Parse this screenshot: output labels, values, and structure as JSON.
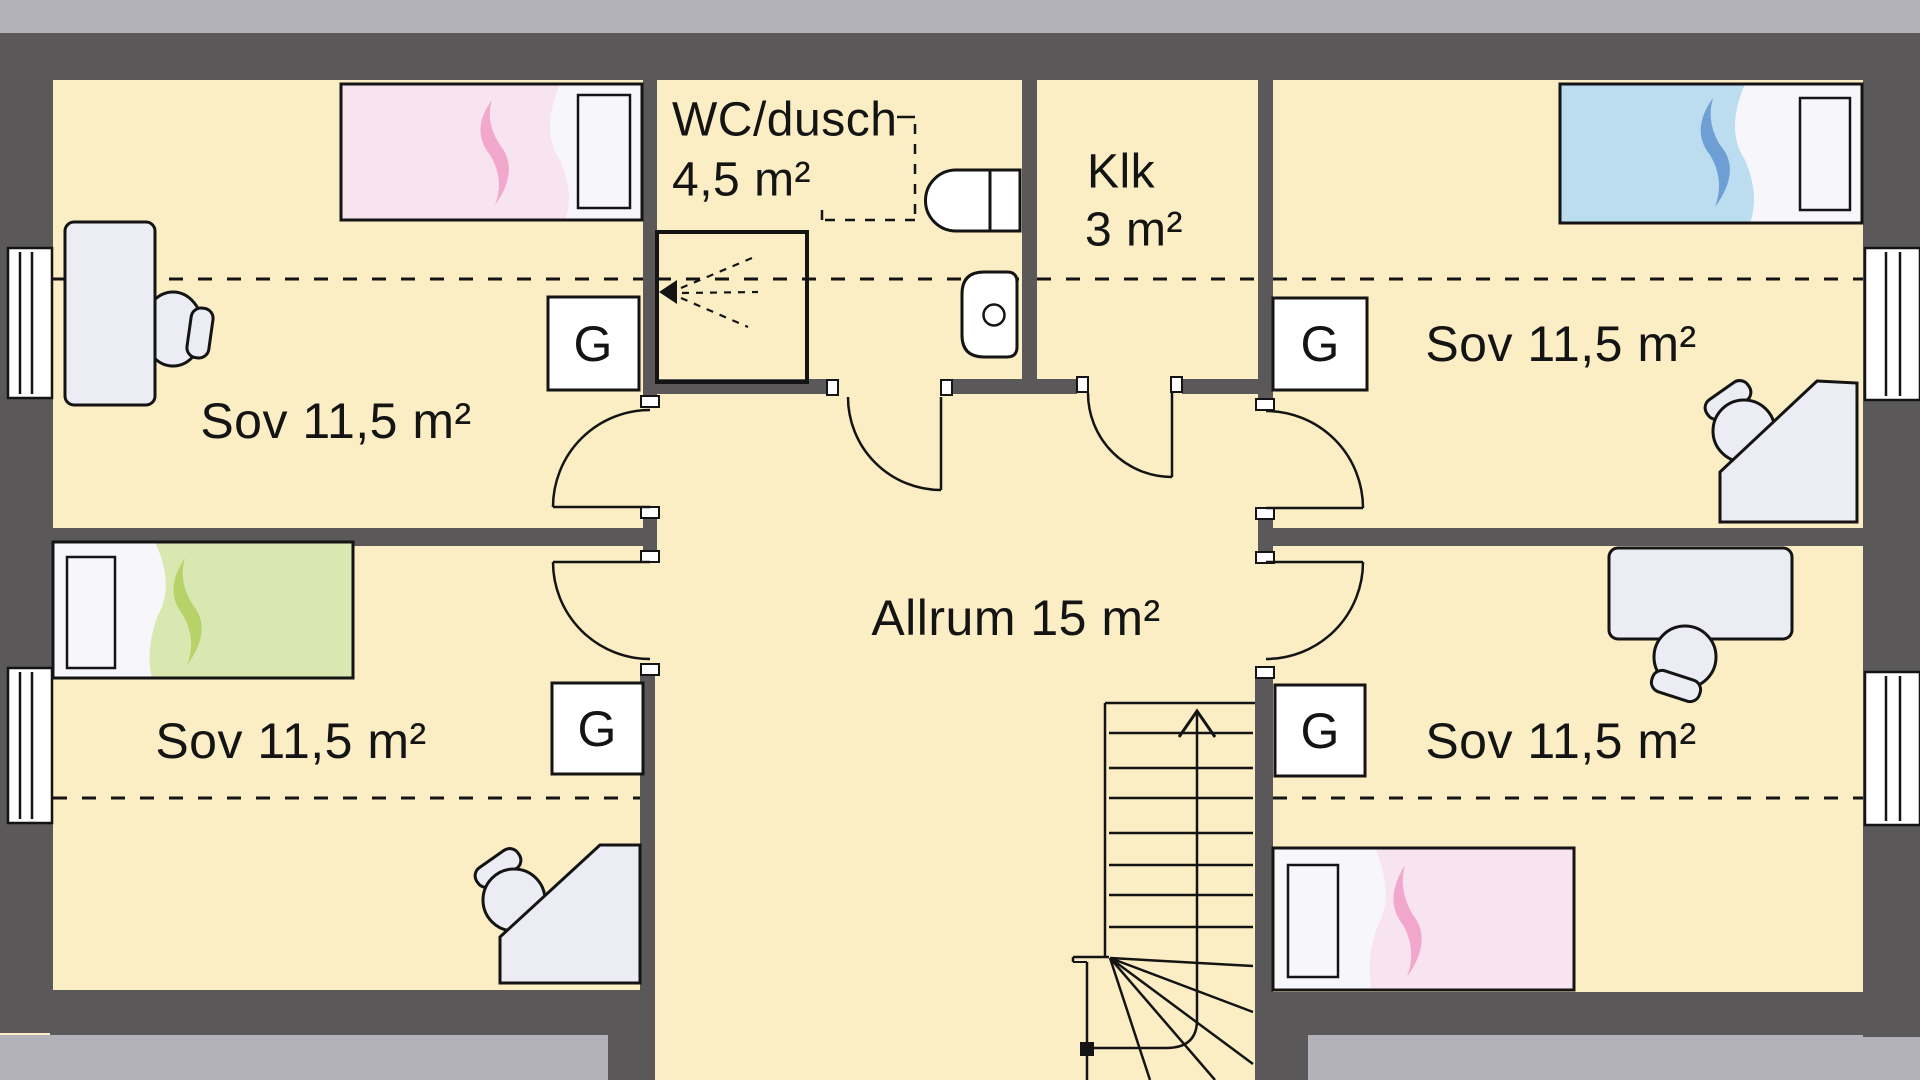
{
  "plan": {
    "title": "Floor plan - upper floor",
    "rooms": {
      "bedroom_nw": {
        "label": "Sov 11,5 m²"
      },
      "bedroom_ne": {
        "label": "Sov 11,5 m²"
      },
      "bedroom_sw": {
        "label": "Sov 11,5 m²"
      },
      "bedroom_se": {
        "label": "Sov 11,5 m²"
      },
      "bathroom": {
        "label": "WC/dusch",
        "area": "4,5 m²"
      },
      "closet": {
        "label": "Klk",
        "area": "3 m²"
      },
      "common": {
        "label": "Allrum 15 m²"
      }
    },
    "wardrobe": {
      "label": "G"
    },
    "colors": {
      "floor": "#FBEDC4",
      "wall": "#5A5858",
      "outside": "#B3B1BA",
      "furniture": "#ECEDF4",
      "bed_pink": "#F8E3F0",
      "bed_pink_swoosh": "#F2A8CC",
      "bed_blue": "#BCDCEF",
      "bed_blue_swoosh": "#6E9FD4",
      "bed_green": "#D9E8B0",
      "bed_green_swoosh": "#B7D269"
    }
  }
}
